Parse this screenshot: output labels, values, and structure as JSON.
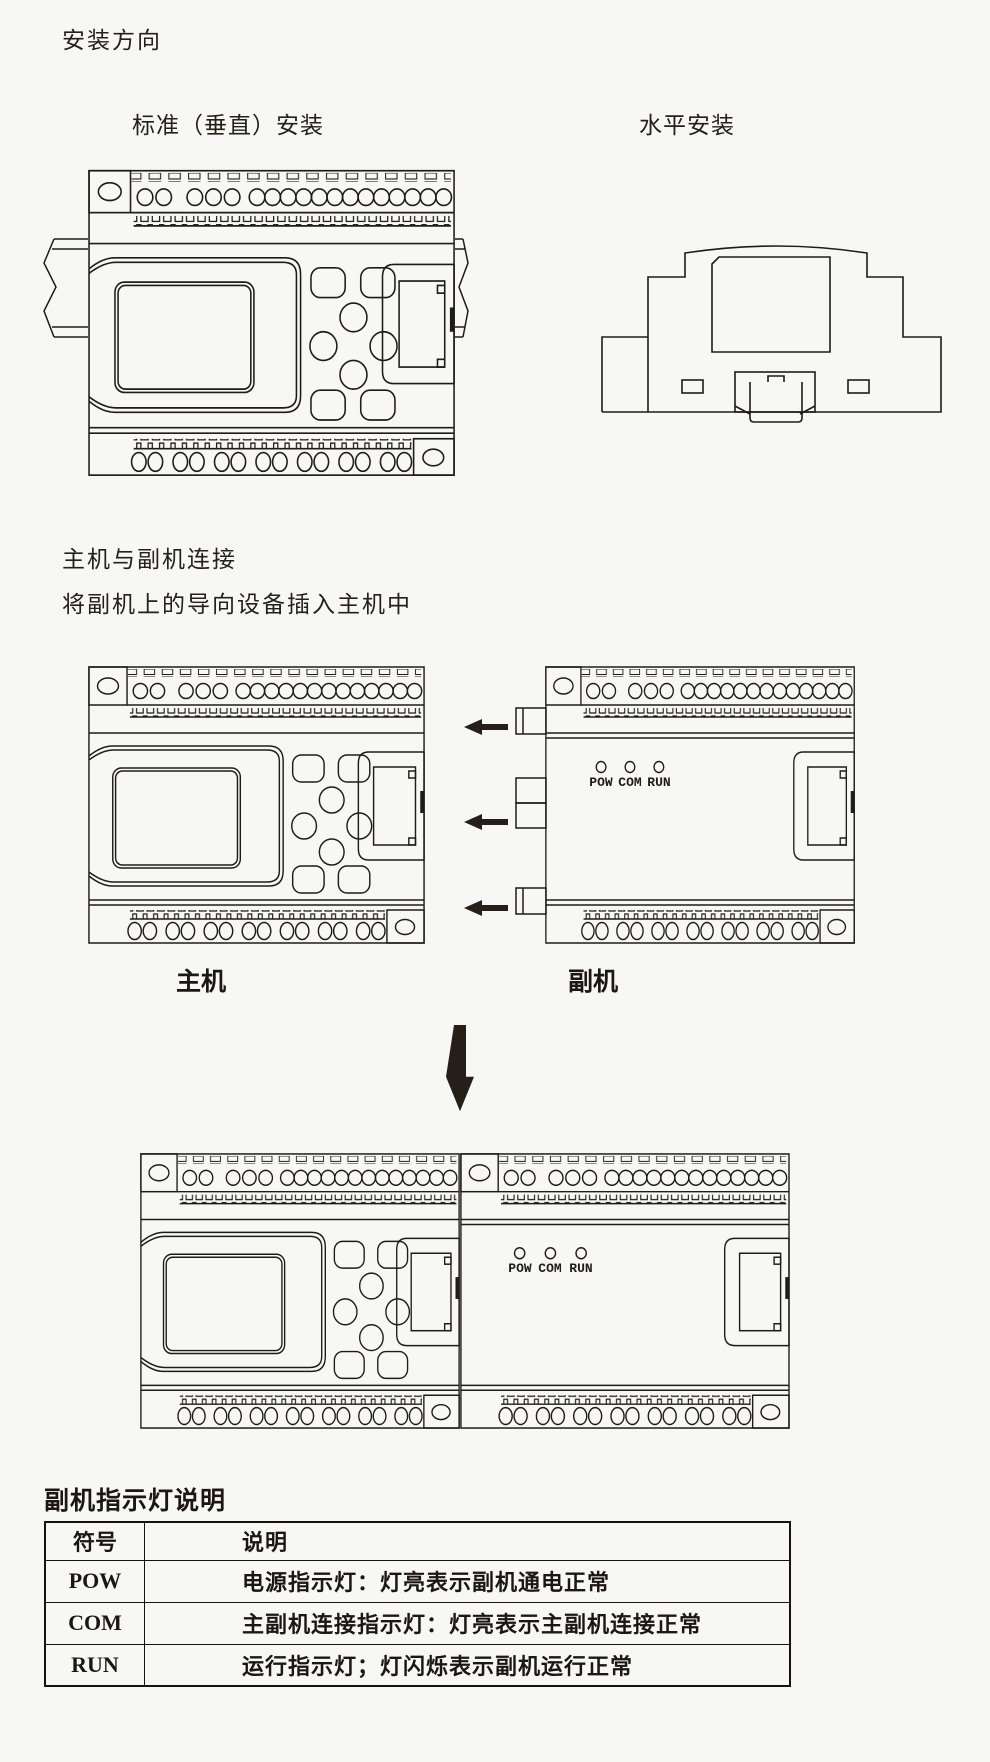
{
  "page": {
    "title": "安装方向",
    "ink": "#201b18",
    "background": "#f7f7f5"
  },
  "install": {
    "vertical_caption": "标准（垂直）安装",
    "horizontal_caption": "水平安装"
  },
  "connect": {
    "heading": "主机与副机连接",
    "subheading": "将副机上的导向设备插入主机中",
    "main_unit_label": "主机",
    "sub_unit_label": "副机"
  },
  "leds": {
    "labels": [
      "POW",
      "COM",
      "RUN"
    ]
  },
  "indicator_table": {
    "heading": "副机指示灯说明",
    "columns": [
      "符号",
      "说明"
    ],
    "rows": [
      {
        "symbol": "POW",
        "desc": "电源指示灯：灯亮表示副机通电正常"
      },
      {
        "symbol": "COM",
        "desc": "主副机连接指示灯：灯亮表示主副机连接正常"
      },
      {
        "symbol": "RUN",
        "desc": "运行指示灯；灯闪烁表示副机运行正常"
      }
    ]
  }
}
